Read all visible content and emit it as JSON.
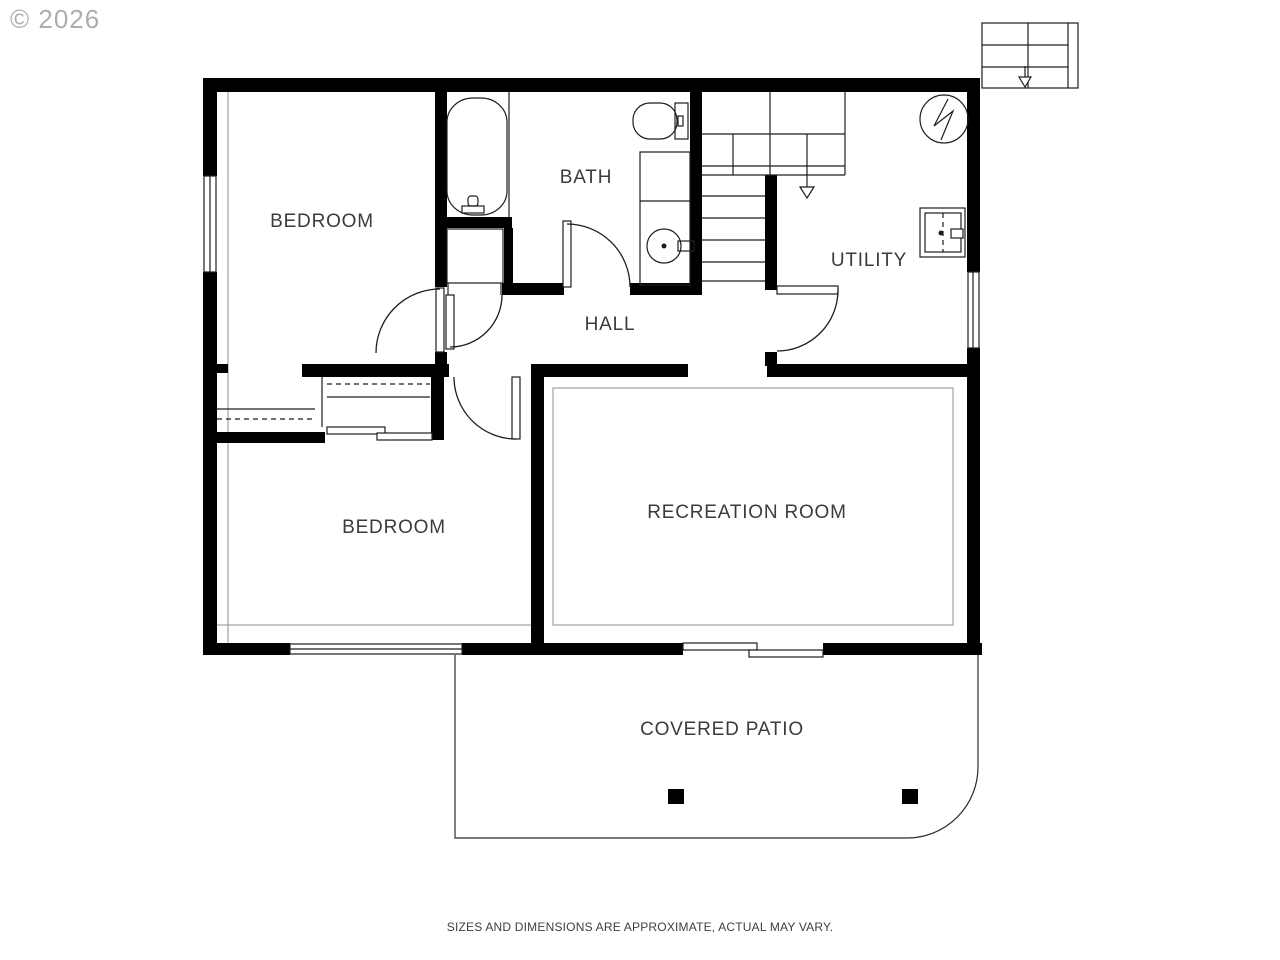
{
  "watermark": "© 2026",
  "disclaimer": "SIZES AND DIMENSIONS ARE APPROXIMATE, ACTUAL MAY VARY.",
  "rooms": {
    "bedroom_upper": "BEDROOM",
    "bath": "BATH",
    "hall": "HALL",
    "utility": "UTILITY",
    "bedroom_lower": "BEDROOM",
    "recreation": "RECREATION ROOM",
    "patio": "COVERED PATIO"
  },
  "fixtures": {
    "bathtub": "bathtub",
    "toilet": "toilet",
    "vanity_sink": "vanity with round sink",
    "water_heater": "water heater",
    "furnace": "furnace/appliance",
    "interior_stairs": "staircase with down arrow",
    "exterior_stairs": "exterior staircase with down arrow",
    "closet_rods": "closet rods and shelves",
    "patio_posts": 2
  },
  "colors": {
    "wall": "#000000",
    "line": "#1d1d1d",
    "label": "#3b3b3b",
    "watermark": "#adadad",
    "inset_line": "#8f8f8f",
    "background": "#ffffff"
  }
}
